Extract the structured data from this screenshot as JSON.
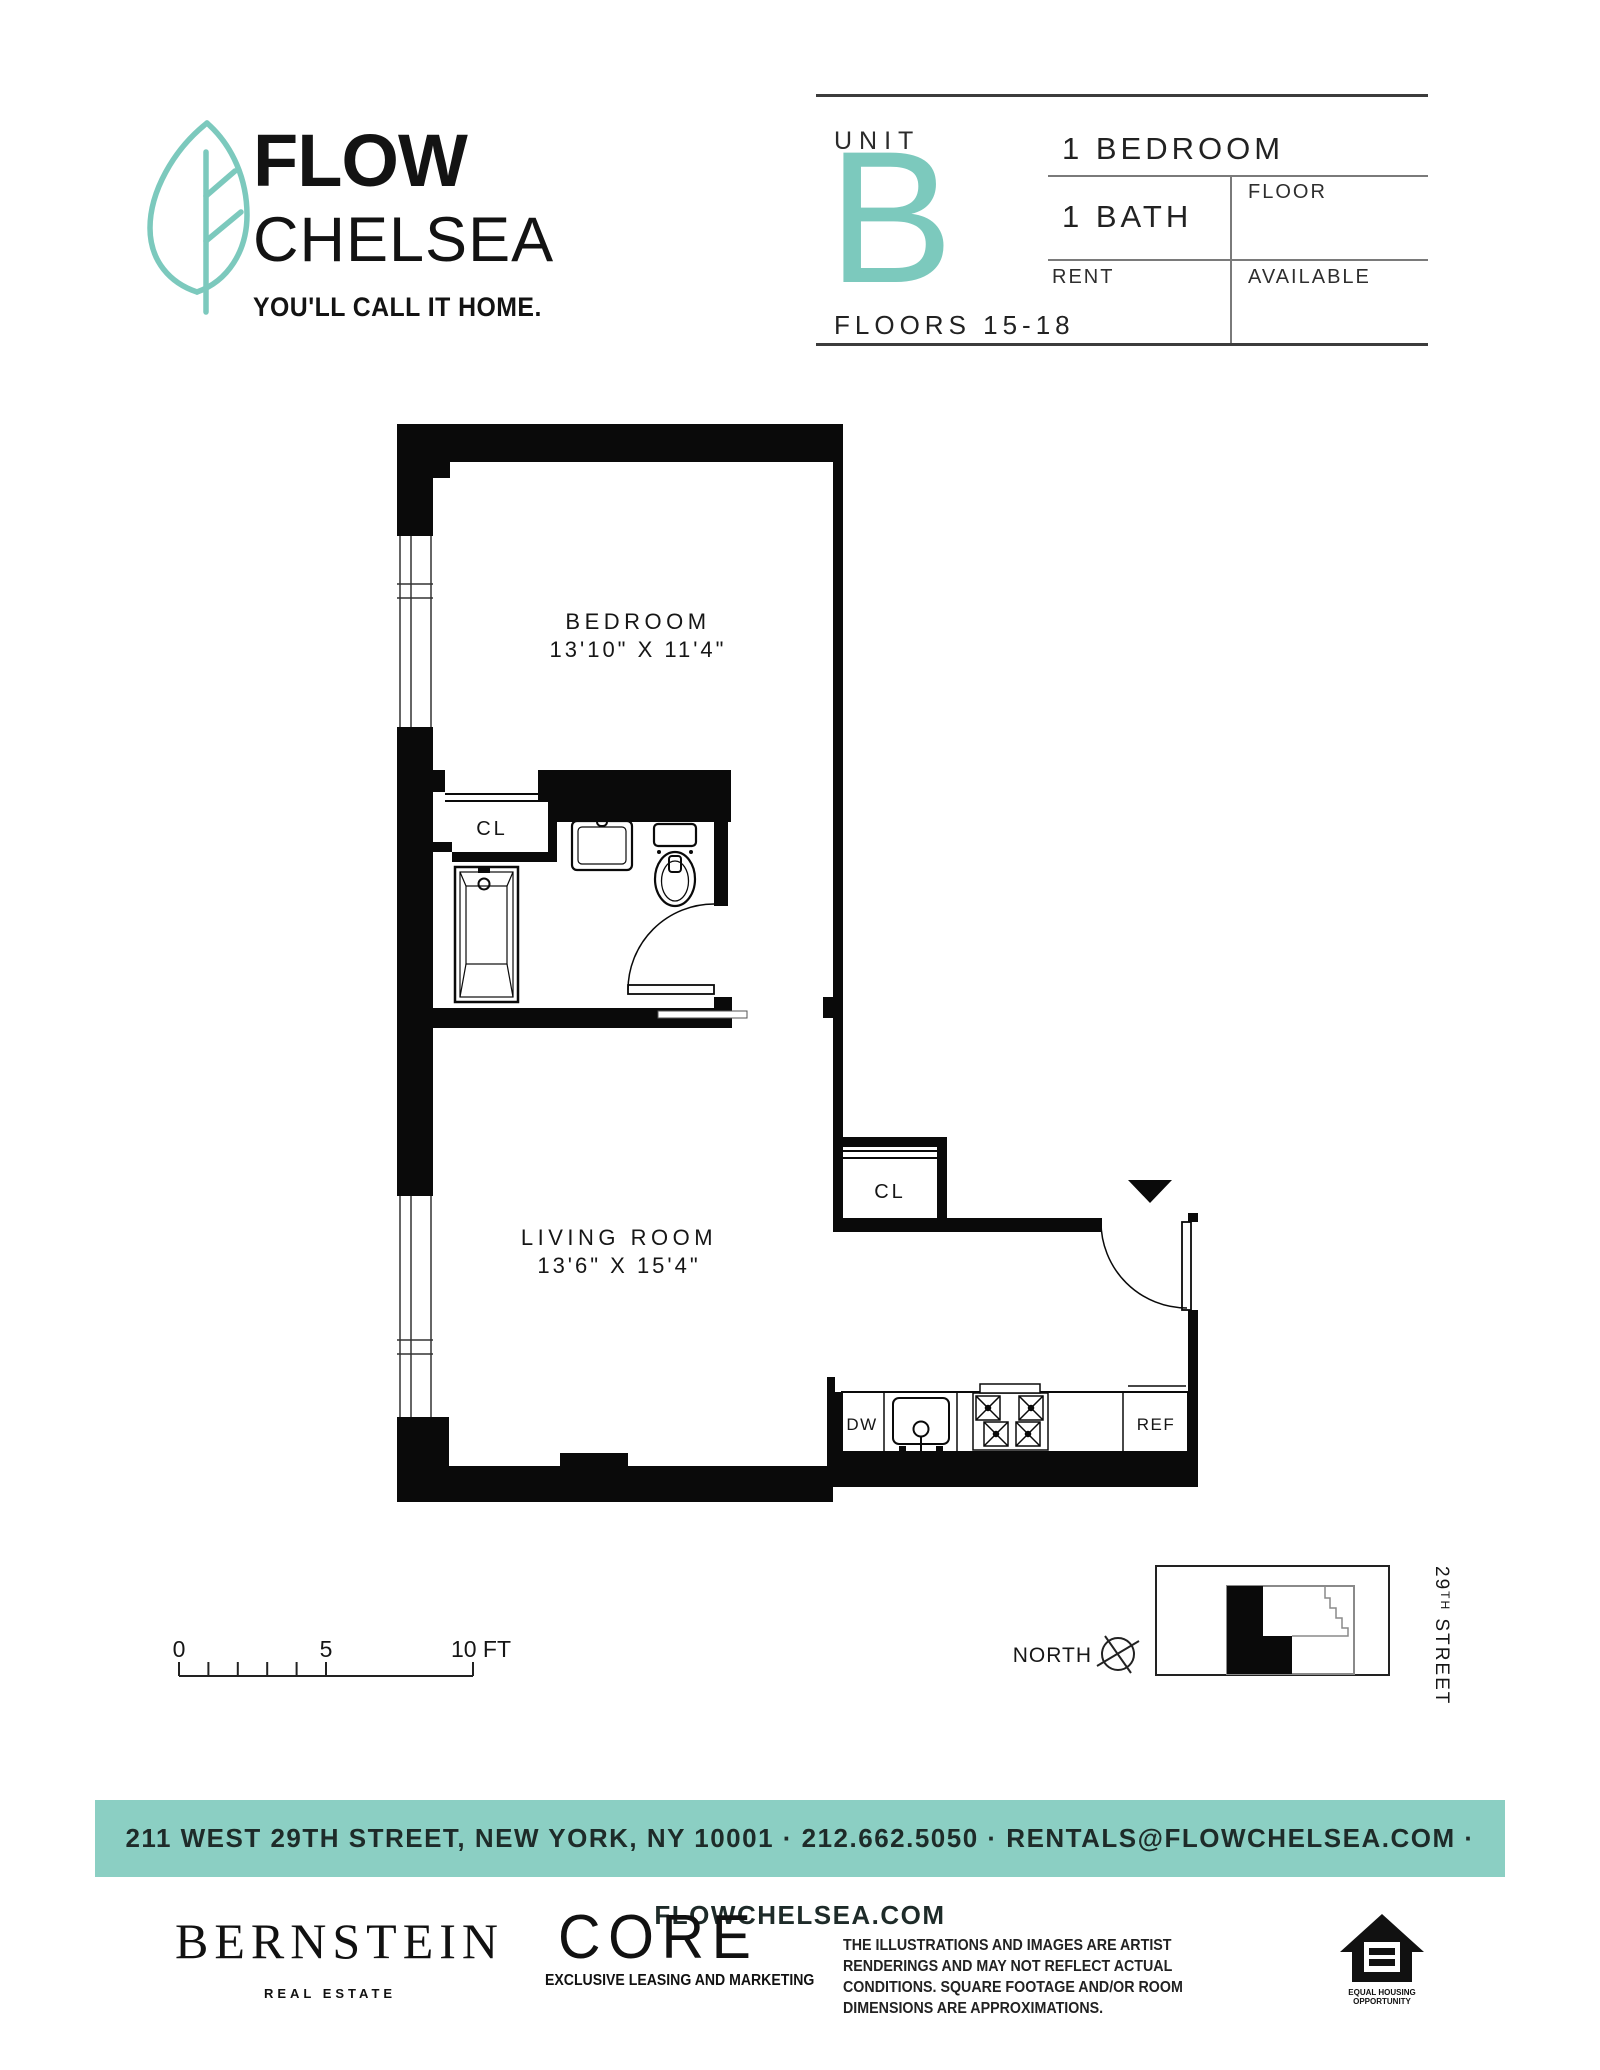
{
  "brand": {
    "name_line1": "FLOW",
    "name_line2": "CHELSEA",
    "tagline": "YOU'LL CALL IT HOME.",
    "accent_color": "#7CC9BD"
  },
  "unit_card": {
    "unit_label": "UNIT",
    "unit_letter": "B",
    "floors": "FLOORS 15-18",
    "bedrooms": "1 BEDROOM",
    "baths": "1 BATH",
    "floor_label": "FLOOR",
    "rent_label": "RENT",
    "available_label": "AVAILABLE"
  },
  "floor_plan": {
    "bedroom_name": "BEDROOM",
    "bedroom_dims": "13'10\" X 11'4\"",
    "living_name": "LIVING ROOM",
    "living_dims": "13'6\" X 15'4\"",
    "closet_bedroom": "CL",
    "closet_entry": "CL",
    "dishwasher": "DW",
    "refrigerator": "REF"
  },
  "scale_bar": {
    "tick0": "0",
    "tick5": "5",
    "tick10": "10 FT"
  },
  "keymap": {
    "north_label": "NORTH",
    "street_num": "29",
    "street_sup": "TH",
    "street_rest": " STREET"
  },
  "banner": {
    "text": "211 WEST 29TH STREET, NEW YORK, NY 10001   ·   212.662.5050   ·   RENTALS@FLOWCHELSEA.COM   ·   FLOWCHELSEA.COM",
    "bg_color": "#8BCFC3"
  },
  "footer": {
    "bernstein": "BERNSTEIN",
    "bernstein_sub": "REAL ESTATE",
    "core": "CORE",
    "core_sub": "EXCLUSIVE LEASING AND MARKETING",
    "disclaimer_line1": "THE ILLUSTRATIONS AND IMAGES ARE ARTIST RENDERINGS AND MAY NOT REFLECT ACTUAL",
    "disclaimer_line2": "CONDITIONS. SQUARE FOOTAGE AND/OR ROOM DIMENSIONS ARE APPROXIMATIONS.",
    "eho_line1": "EQUAL HOUSING",
    "eho_line2": "OPPORTUNITY"
  }
}
